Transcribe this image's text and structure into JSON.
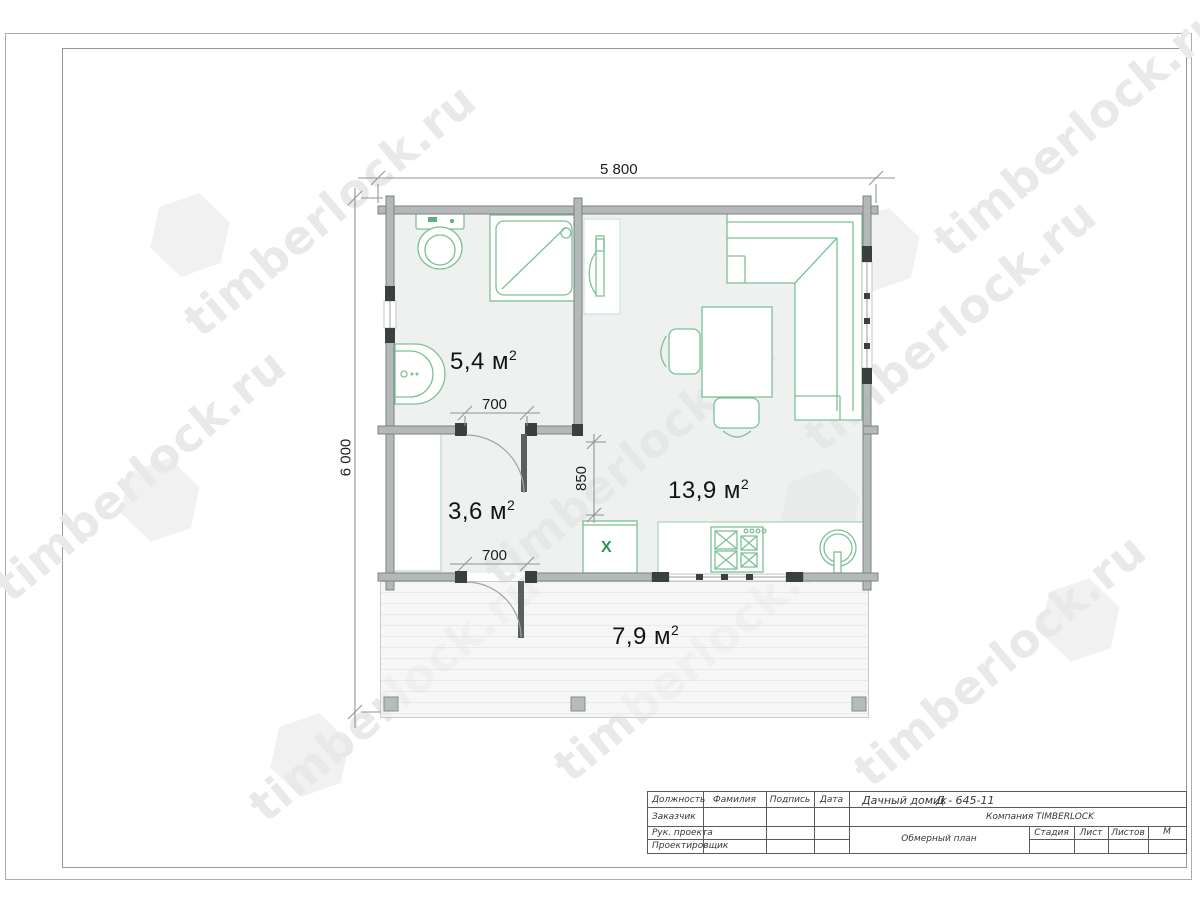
{
  "watermark": {
    "text": "timberlock.ru"
  },
  "plan": {
    "dim_width": "5 800",
    "dim_height": "6 000",
    "dim_door_top": "700",
    "dim_door_bottom": "700",
    "dim_passage": "850",
    "rooms": [
      {
        "name": "bathroom",
        "area": "5,4",
        "unit": " м",
        "sup": "2"
      },
      {
        "name": "hall",
        "area": "3,6",
        "unit": " м",
        "sup": "2"
      },
      {
        "name": "living-room",
        "area": "13,9",
        "unit": " м",
        "sup": "2"
      },
      {
        "name": "terrace",
        "area": "7,9",
        "unit": " м",
        "sup": "2"
      }
    ],
    "fridge_symbol": "X"
  },
  "title_block": {
    "header_position": "Должность",
    "header_surname": "Фамилия",
    "header_signature": "Подпись",
    "header_date": "Дата",
    "row_customer": "Заказчик",
    "row_project_lead": "Рук. проекта",
    "row_designer": "Проектировщик",
    "project_type": "Дачный домик",
    "project_code": "Д - 645-11",
    "company_label": "Компания",
    "company_name": "TIMBERLOCK",
    "drawing_name": "Обмерный план",
    "col_stage": "Стадия",
    "col_sheet": "Лист",
    "col_sheets": "Листов",
    "col_scale": "М"
  },
  "colors": {
    "wall": "#b3b8b8",
    "wall_edge": "#7d8384",
    "joinery": "#3a3f40",
    "fixture_green": "#7cc096",
    "accent_green": "#2f9456",
    "room_fill": "#e4e7e6",
    "dim_line": "#8f9495",
    "frame": "#9aa0a1",
    "watermark_gray": "#e9e9e9"
  }
}
